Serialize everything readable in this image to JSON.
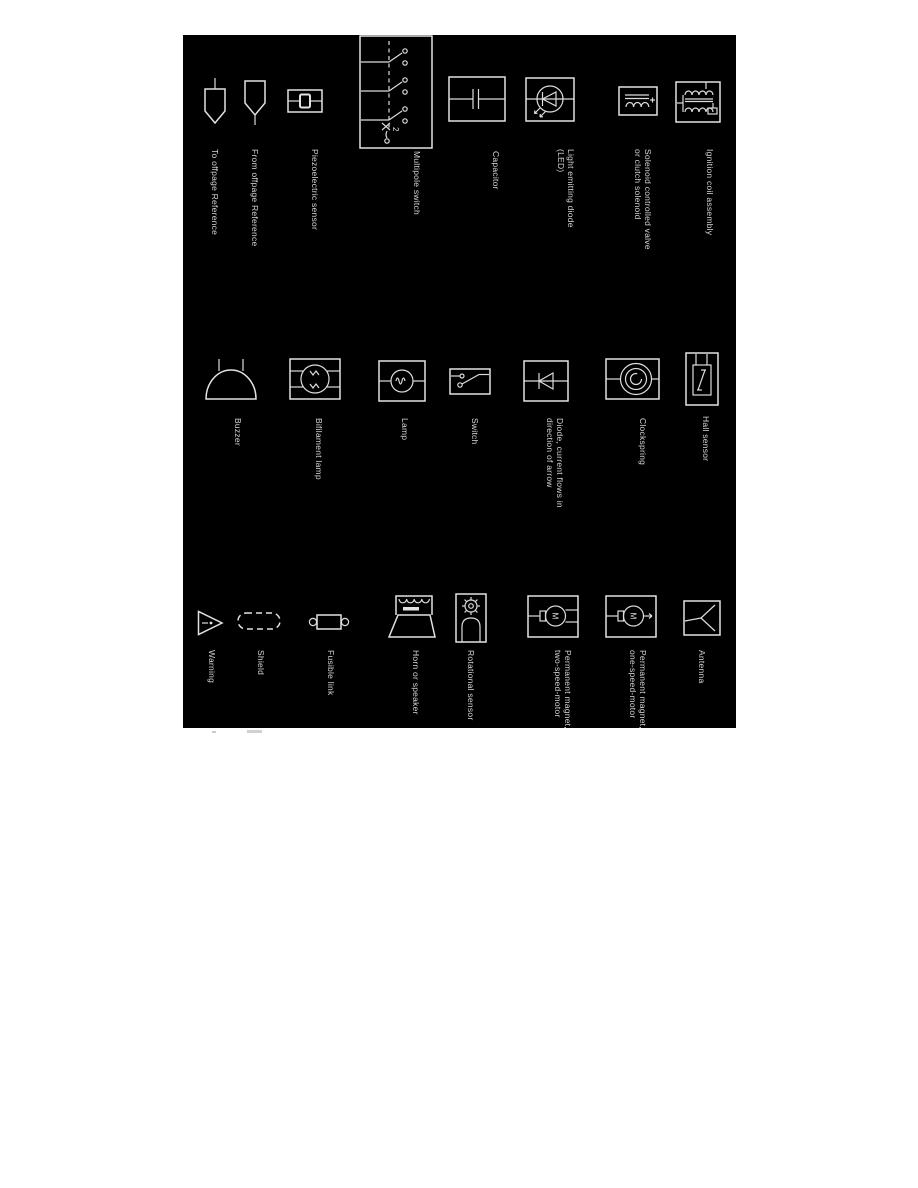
{
  "panel": {
    "bg": "#000000",
    "fg": "#e2e2e2"
  },
  "symbols": {
    "col1": [
      {
        "name": "to-offpage-reference",
        "lines": [
          "To offpage Reference"
        ]
      },
      {
        "name": "from-offpage-reference",
        "lines": [
          "From offpage Reference"
        ]
      },
      {
        "name": "piezoelectric-sensor",
        "lines": [
          "Piezoelectric sensor"
        ]
      },
      {
        "name": "multipole-switch",
        "lines": [
          "Multipole switch"
        ],
        "pole_label": "2"
      },
      {
        "name": "capacitor",
        "lines": [
          "Capacitor"
        ]
      },
      {
        "name": "light-emitting-diode",
        "lines": [
          "Light emitting diode",
          "(LED)"
        ]
      },
      {
        "name": "solenoid-valve",
        "lines": [
          "Solenoid controlled valve",
          "or clutch solenoid"
        ]
      },
      {
        "name": "ignition-coil",
        "lines": [
          "Ignition coil assembly"
        ]
      }
    ],
    "col2": [
      {
        "name": "buzzer",
        "lines": [
          "Buzzer"
        ]
      },
      {
        "name": "bifilament-lamp",
        "lines": [
          "Bifilament lamp"
        ]
      },
      {
        "name": "lamp",
        "lines": [
          "Lamp"
        ]
      },
      {
        "name": "switch",
        "lines": [
          "Switch"
        ]
      },
      {
        "name": "diode",
        "lines": [
          "Diode, current flows in",
          "direction of arrow"
        ]
      },
      {
        "name": "clockspring",
        "lines": [
          "Clockspring"
        ]
      },
      {
        "name": "hall-sensor",
        "lines": [
          "Hall sensor"
        ]
      }
    ],
    "col3": [
      {
        "name": "warning",
        "lines": [
          "Warning"
        ]
      },
      {
        "name": "shield",
        "lines": [
          "Shield"
        ]
      },
      {
        "name": "fusible-link",
        "lines": [
          "Fusible link"
        ]
      },
      {
        "name": "horn-or-speaker",
        "lines": [
          "Horn or speaker"
        ]
      },
      {
        "name": "rotational-sensor",
        "lines": [
          "Rotational sensor"
        ]
      },
      {
        "name": "pm-two-speed-motor",
        "lines": [
          "Permanent magnet,",
          "two-speed-motor"
        ],
        "motor_letter": "M"
      },
      {
        "name": "pm-one-speed-motor",
        "lines": [
          "Permanent magnet,",
          "one-speed-motor"
        ],
        "motor_letter": "M"
      },
      {
        "name": "antenna",
        "lines": [
          "Antenna"
        ]
      }
    ]
  }
}
